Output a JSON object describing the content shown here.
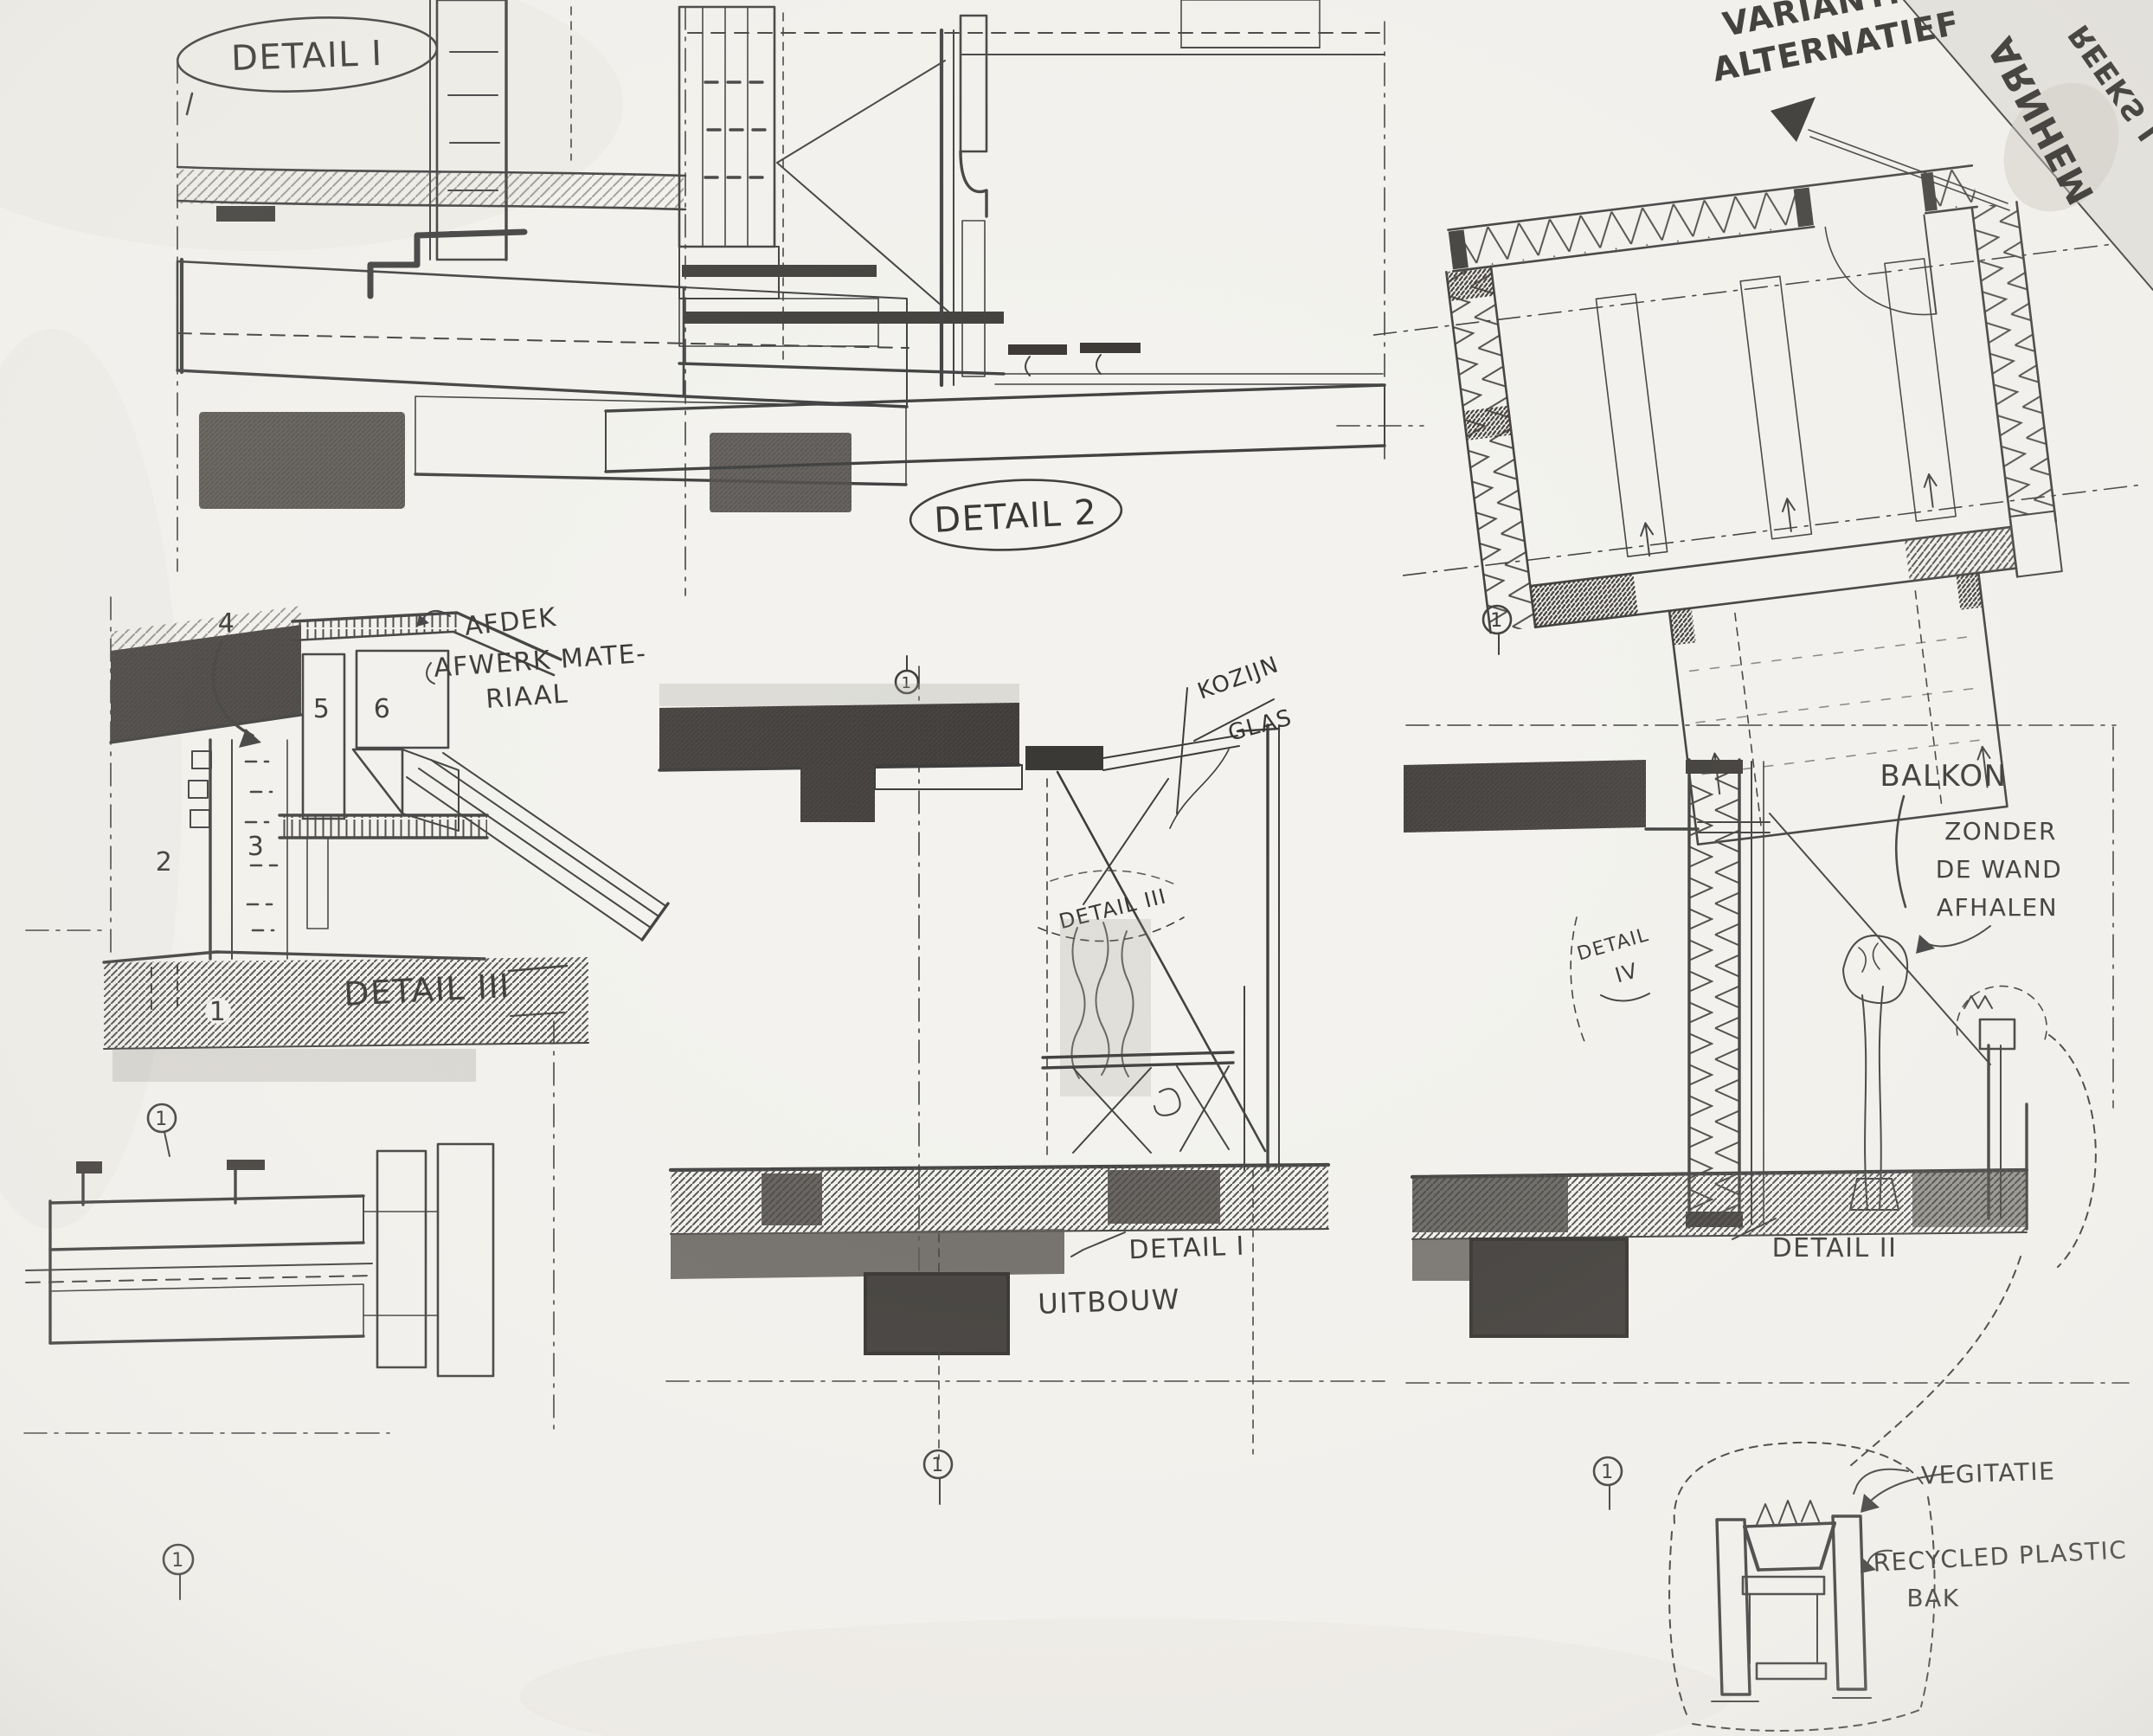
{
  "colors": {
    "paper": "#f3f2ee",
    "ink": "#3a3a3a",
    "pencil_shadow": "#55514c",
    "dark_fill": "#3b3835"
  },
  "labels": {
    "detail1": "DETAIL I",
    "detail2": "DETAIL 2",
    "detail3": "DETAIL III",
    "detail3_note1": "AFDEK",
    "detail3_note2": "AFWERK MATE-",
    "detail3_note3": "RIAAL",
    "n1": "1",
    "n2": "2",
    "n3": "3",
    "n4": "4",
    "n5": "5",
    "n6": "6",
    "variant1": "VARIANT:",
    "variant2": "ALTERNATIEF",
    "mirror1": "ARNHEM",
    "mirror2": "REEKS I",
    "kozijn": "KOZIJN",
    "glas": "GLAS",
    "ref_detail3": "DETAIL III",
    "ref_detail4a": "DETAIL",
    "ref_detail4b": "IV",
    "balkon": "BALKON",
    "zonder": "ZONDER",
    "dewand": "DE WAND",
    "afhalen": "AFHALEN",
    "ref_detail1": "DETAIL I",
    "uitbouw": "UITBOUW",
    "ref_detail2": "DETAIL II",
    "vegitatie": "VEGITATIE",
    "recycled": "RECYCLED PLASTIC",
    "bak": "BAK",
    "marker": "1"
  }
}
